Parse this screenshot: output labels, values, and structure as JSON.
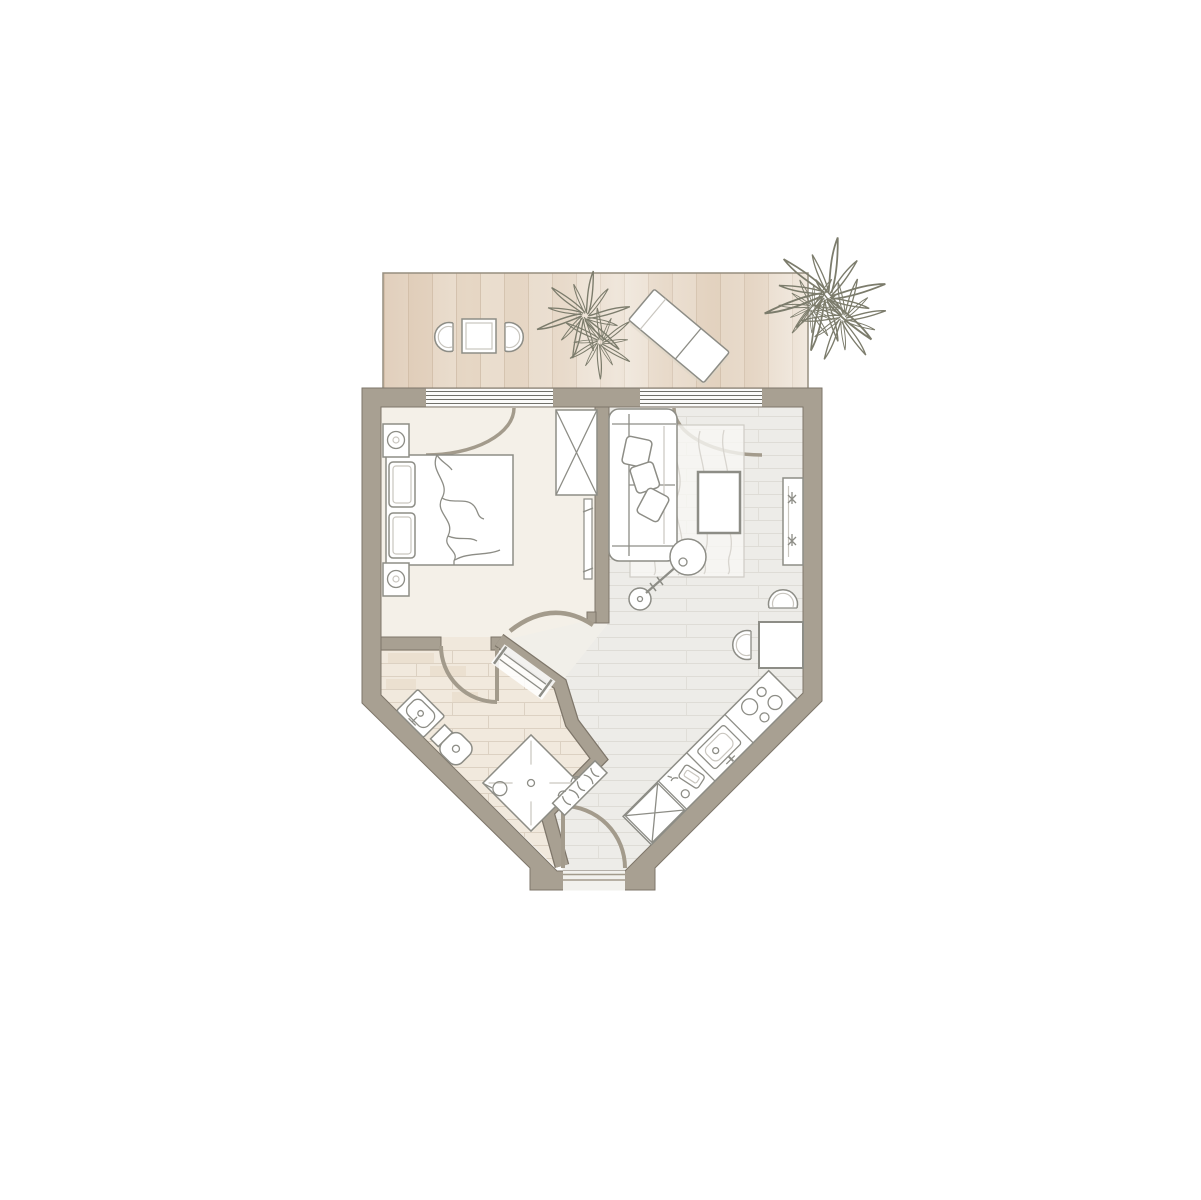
{
  "canvas": {
    "width": 1201,
    "height": 1200,
    "background": "#ffffff"
  },
  "colors": {
    "wall": "#a8a092",
    "wall_outline": "#7e766a",
    "bedroom_floor": "#f4f0e8",
    "plank_base": "#edece8",
    "plank_line": "#dedcd6",
    "tile_base": "#f1e9dd",
    "tile_line": "#dcd1c2",
    "deck_base": "#ebdfd0",
    "deck_alt": "#e6d7c5",
    "deck_line": "#d4c3af",
    "furniture_stroke": "#8d8d86",
    "furniture_fill": "#ffffff",
    "door_arc": "#a39b8c",
    "plant_stroke": "#7c7c6c",
    "rug_line": "#d8d5cf"
  },
  "plan": {
    "kind": "apartment-floor-plan",
    "rooms": [
      {
        "id": "balcony",
        "items": [
          "bistro-table",
          "bistro-chair-left",
          "bistro-chair-right",
          "lounge-chair",
          "balcony-plant",
          "corner-plant"
        ]
      },
      {
        "id": "bedroom",
        "items": [
          "double-bed",
          "pillow",
          "pillow",
          "duvet",
          "nightstand-top",
          "nightstand-bottom",
          "wardrobe",
          "wall-mirror",
          "balcony-door"
        ]
      },
      {
        "id": "living-room",
        "items": [
          "sofa",
          "sofa-cushions",
          "area-rug",
          "coffee-table",
          "arc-floor-lamp",
          "sideboard",
          "dining-table",
          "dining-chair-top",
          "dining-chair-left",
          "balcony-door"
        ]
      },
      {
        "id": "bathroom",
        "items": [
          "washbasin",
          "toilet",
          "shower",
          "towel-radiator",
          "towel-rail",
          "bathroom-door"
        ]
      },
      {
        "id": "kitchen",
        "items": [
          "kitchen-counter",
          "cooktop",
          "kitchen-sink",
          "dish-rack",
          "appliance-cabinet"
        ]
      },
      {
        "id": "hallway",
        "items": [
          "entrance-door",
          "bedroom-door"
        ]
      }
    ],
    "window_count": 2,
    "door_count": 5
  }
}
